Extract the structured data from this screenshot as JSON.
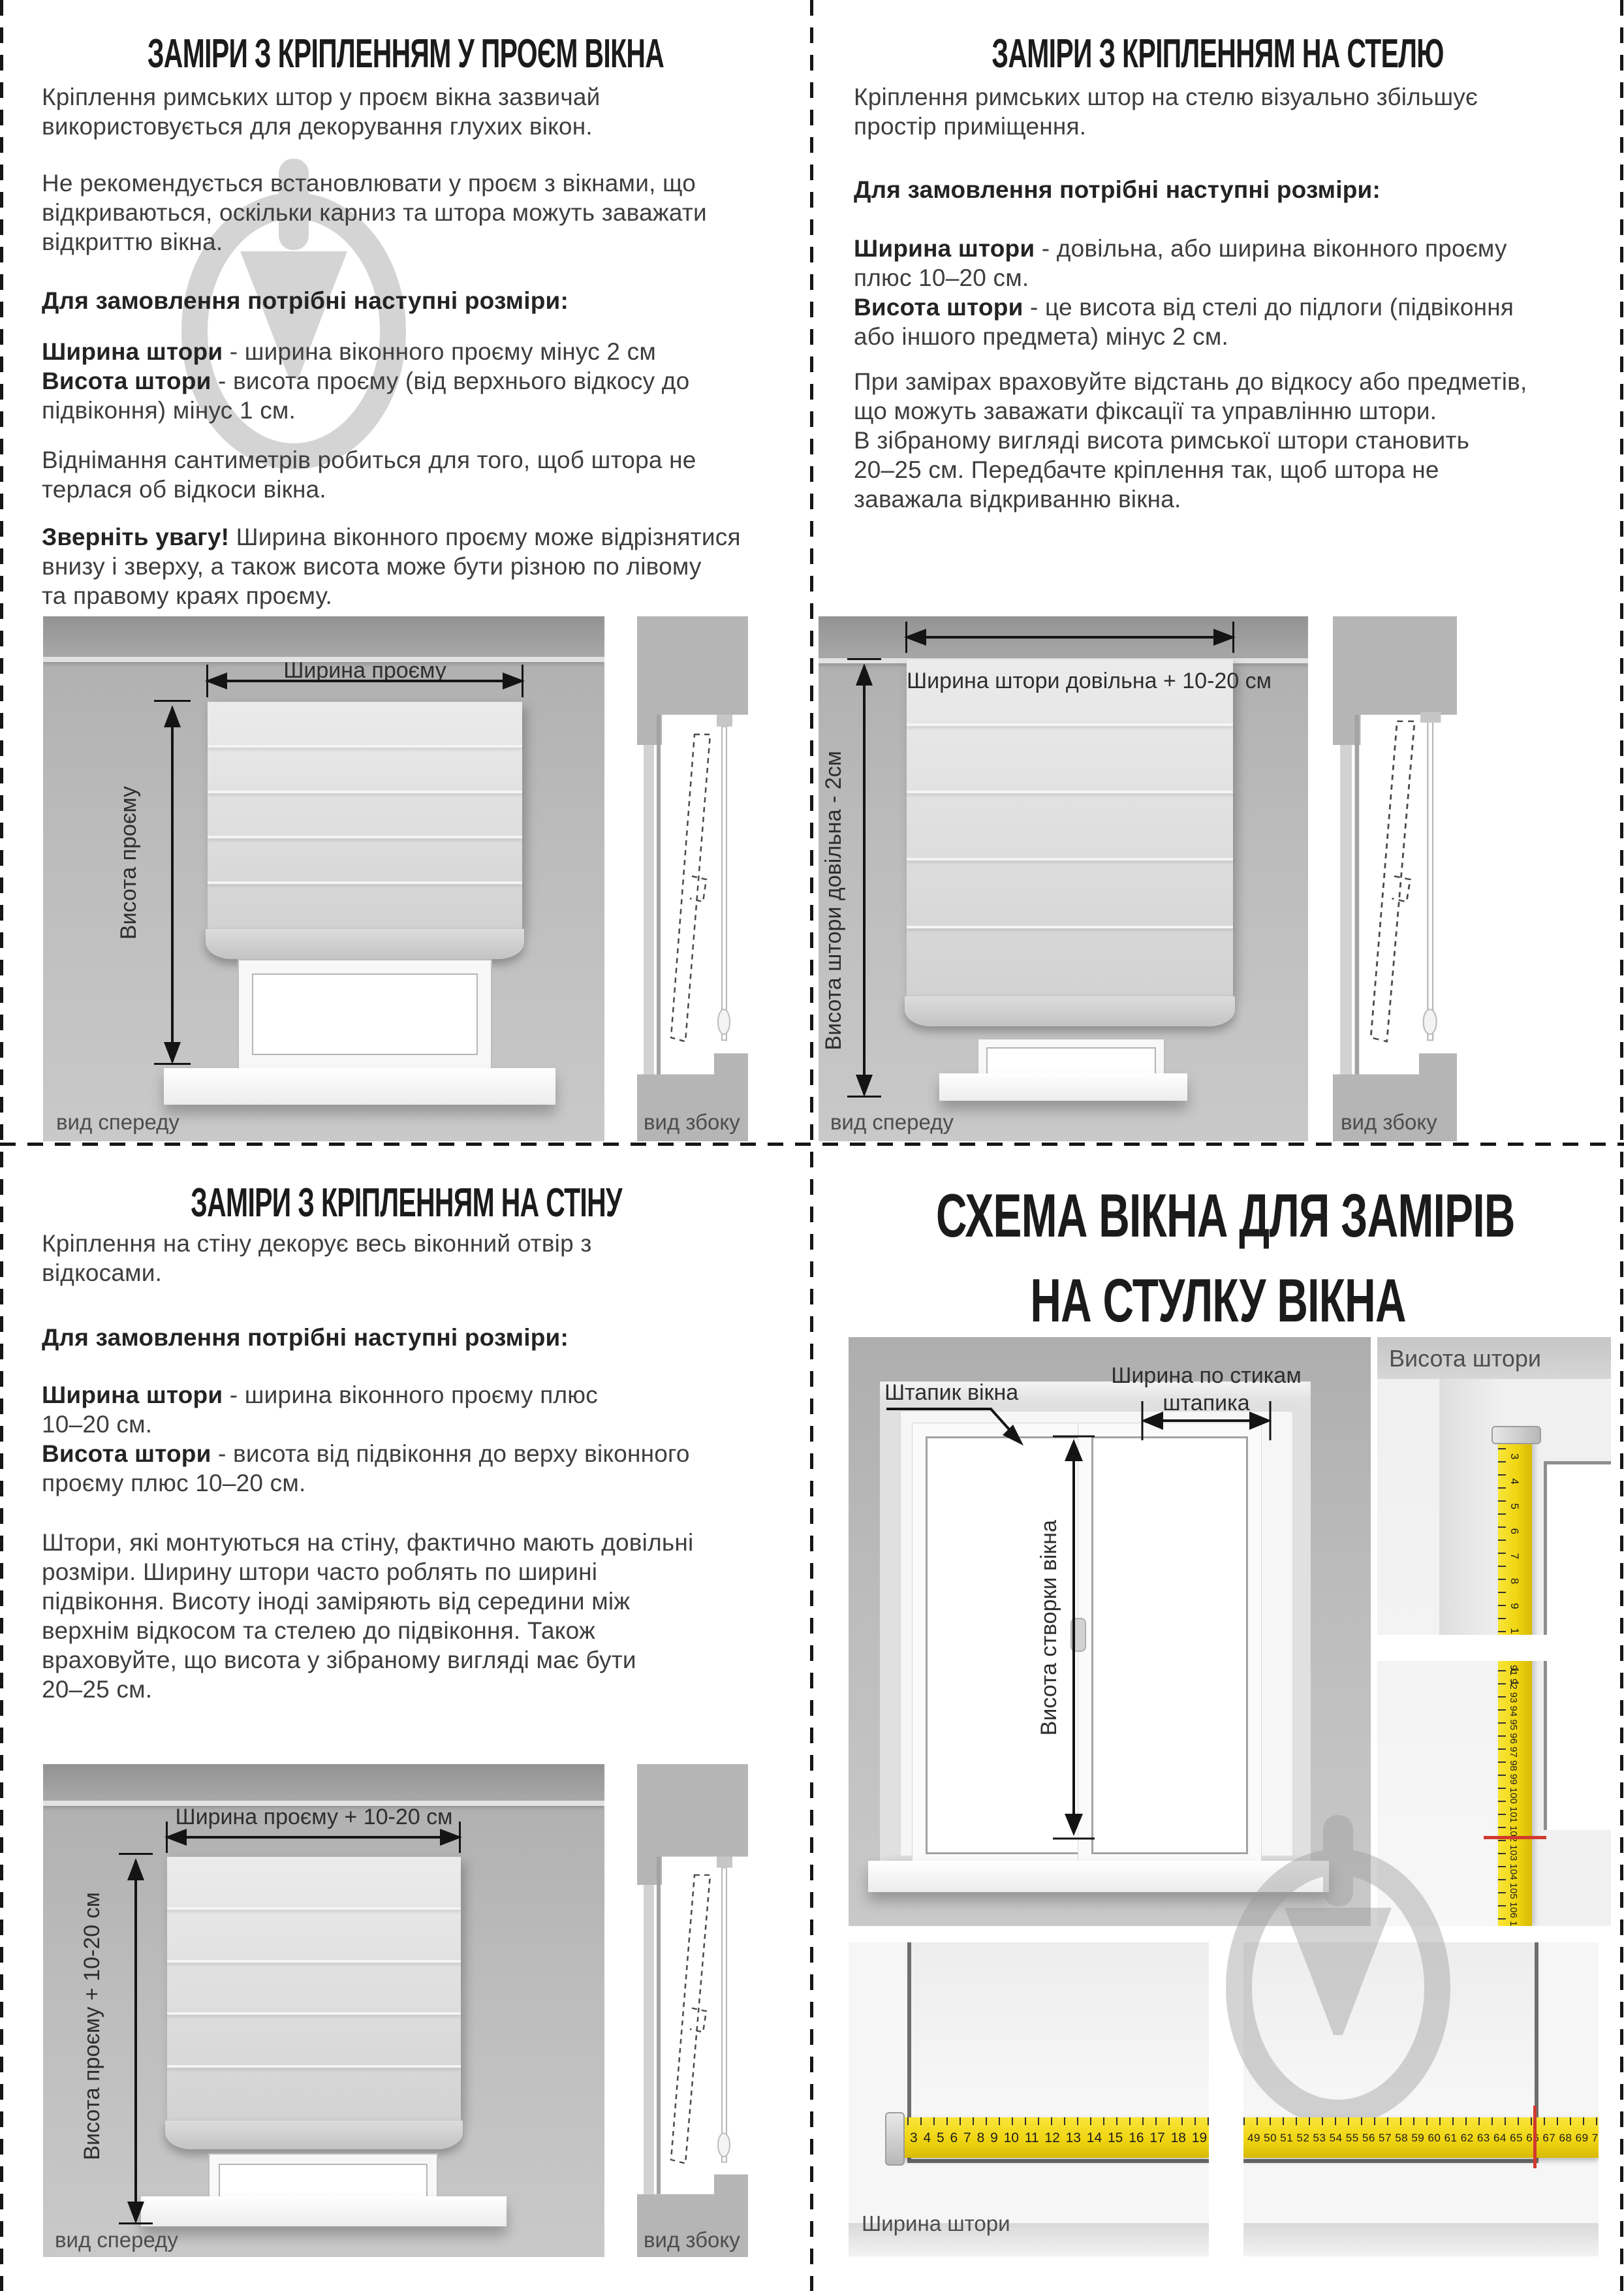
{
  "colors": {
    "tape_yellow": "#f0d512",
    "mark_red": "#d13a2e",
    "watermark_gray": "#9a9a9a",
    "text_gray": "#3e3e3e"
  },
  "sections": {
    "in_opening": {
      "title": "ЗАМІРИ З КРІПЛЕННЯМ У ПРОЄМ ВІКНА",
      "p1": [
        "Кріплення римських штор у проєм вікна зазвичай",
        "використовується для декорування глухих вікон."
      ],
      "p2": [
        "Не рекомендується встановлювати у проєм з вікнами, що",
        "відкриваються, оскільки карниз та штора можуть заважати",
        "відкриттю вікна."
      ],
      "order_heading": "Для замовлення потрібні наступні розміри:",
      "width_term": "Ширина штори",
      "width_rest": " - ширина віконного проєму мінус 2 см",
      "height_term": "Висота штори",
      "height_rest": " - висота проєму (від верхнього відкосу до",
      "height_cont": "підвіконня) мінус 1 см.",
      "p3": [
        "Віднімання сантиметрів робиться для того, щоб штора не",
        "терлася об відкоси вікна."
      ],
      "note_label": "Зверніть увагу!",
      "note_rest": " Ширина віконного проєму може відрізнятися",
      "note_lines": [
        "внизу і зверху, а також висота може бути різною по лівому",
        "та правому краях проєму."
      ],
      "diagram": {
        "width_label": "Ширина проєму",
        "height_label": "Висота проєму",
        "front_view": "вид спереду",
        "side_view": "вид збоку"
      }
    },
    "ceiling": {
      "title": "ЗАМІРИ З КРІПЛЕННЯМ НА СТЕЛЮ",
      "p1": [
        "Кріплення римських штор на стелю візуально збільшує",
        "простір приміщення."
      ],
      "order_heading": "Для замовлення потрібні наступні розміри:",
      "width_term": "Ширина штори",
      "width_rest": " - довільна, або ширина віконного проєму",
      "width_cont": "плюс 10–20 см.",
      "height_term": "Висота штори",
      "height_rest": " - це висота від стелі до підлоги (підвіконня",
      "height_cont": "або іншого предмета) мінус 2 см.",
      "p3": [
        "При замірах враховуйте відстань до відкосу або предметів,",
        "що можуть заважати фіксації та управлінню штори.",
        "В зібраному вигляді висота римської штори становить",
        "20–25 см. Передбачте кріплення так, щоб штора не",
        "заважала відкриванню вікна."
      ],
      "diagram": {
        "width_label": "Ширина штори довільна + 10-20 см",
        "height_label": "Висота штори довільна - 2см",
        "front_view": "вид спереду",
        "side_view": "вид збоку"
      }
    },
    "wall": {
      "title": "ЗАМІРИ З КРІПЛЕННЯМ НА СТІНУ",
      "p1": [
        "Кріплення на стіну декорує весь віконний отвір з",
        "відкосами."
      ],
      "order_heading": "Для замовлення потрібні наступні розміри:",
      "width_term": "Ширина штори",
      "width_rest": " - ширина віконного проєму плюс",
      "width_cont": "10–20 см.",
      "height_term": "Висота штори",
      "height_rest": " - висота від підвіконня до верху віконного",
      "height_cont": "проєму плюс 10–20 см.",
      "p3": [
        "Штори, які монтуються на стіну, фактично мають довільні",
        "розміри. Ширину штори часто роблять по ширині",
        "підвіконня. Висоту іноді заміряють від середини між",
        "верхнім відкосом та стелею до підвіконня. Також",
        "враховуйте, що висота у зібраному вигляді має бути",
        "20–25 см."
      ],
      "diagram": {
        "width_label": "Ширина проєму + 10-20 см",
        "height_label": "Висота проєму + 10-20 см",
        "front_view": "вид спереду",
        "side_view": "вид збоку"
      }
    },
    "sash_schema": {
      "title_lines": [
        "СХЕМА ВІКНА ДЛЯ ЗАМІРІВ",
        "НА СТУЛКУ ВІКНА"
      ],
      "bead_label": "Штапик вікна",
      "width_by_bead": [
        "Ширина по стикам",
        "штапика"
      ],
      "sash_height_label": "Висота створки вікна",
      "curtain_height_label": "Висота штори",
      "curtain_width_label": "Ширина штори",
      "tape_v_top": "3 4 5 6 7 8 9 10 11",
      "tape_v_bottom": "91 92 93 94 95 96 97 98 99 100 101 102 103 104 105 106 107 108 109 110",
      "tape_h_left": "3 4 5 6 7 8 9 10 11 12 13 14 15 16 17 18 19 20 21 22 23 24",
      "tape_h_right": "49 50 51 52 53 54 55 56 57 58 59 60 61 62 63 64 65 66 67 68 69 70 71 72 73 74 75 76 77 78 79"
    }
  }
}
